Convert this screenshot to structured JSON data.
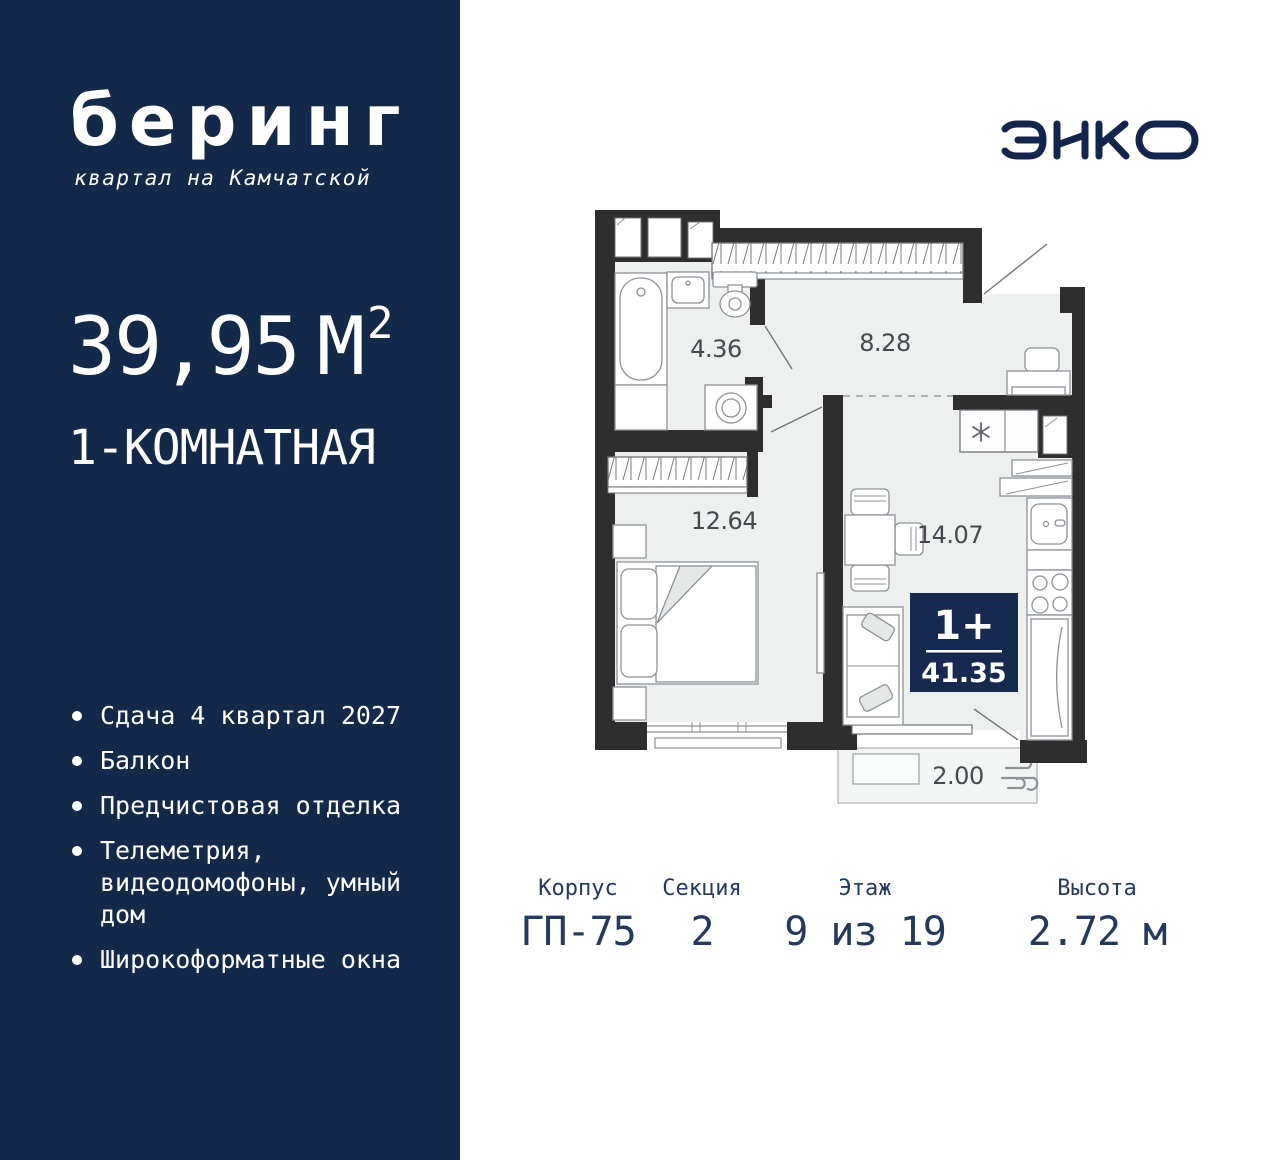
{
  "sidebar": {
    "logo_title": "беринг",
    "logo_subtitle": "квартал на Камчатской",
    "area_value": "39,95",
    "area_unit": "М",
    "area_sup": "2",
    "rooms_label": "1-КОМНАТНАЯ",
    "features": [
      "Сдача 4 квартал 2027",
      "Балкон",
      "Предчистовая отделка",
      "Телеметрия, видеодомофоны, умный дом",
      "Широкоформатные окна"
    ]
  },
  "brand": {
    "name": "ЭНКО"
  },
  "plan": {
    "rooms": {
      "bathroom": "4.36",
      "hallway": "8.28",
      "bedroom": "12.64",
      "kitchen_living": "14.07",
      "balcony": "2.00"
    },
    "badge": {
      "type": "1+",
      "total_area": "41.35"
    }
  },
  "info": {
    "items": [
      {
        "label": "Корпус",
        "value": "ГП-75"
      },
      {
        "label": "Секция",
        "value": "2"
      },
      {
        "label": "Этаж",
        "value": "9 из 19"
      },
      {
        "label": "Высота",
        "value": "2.72 м"
      }
    ]
  },
  "colors": {
    "sidebar_bg": "#12294a",
    "badge_bg": "#152a4e",
    "navy_text": "#24395e",
    "wall": "#2e2e2e",
    "floor": "#eef0ef"
  }
}
